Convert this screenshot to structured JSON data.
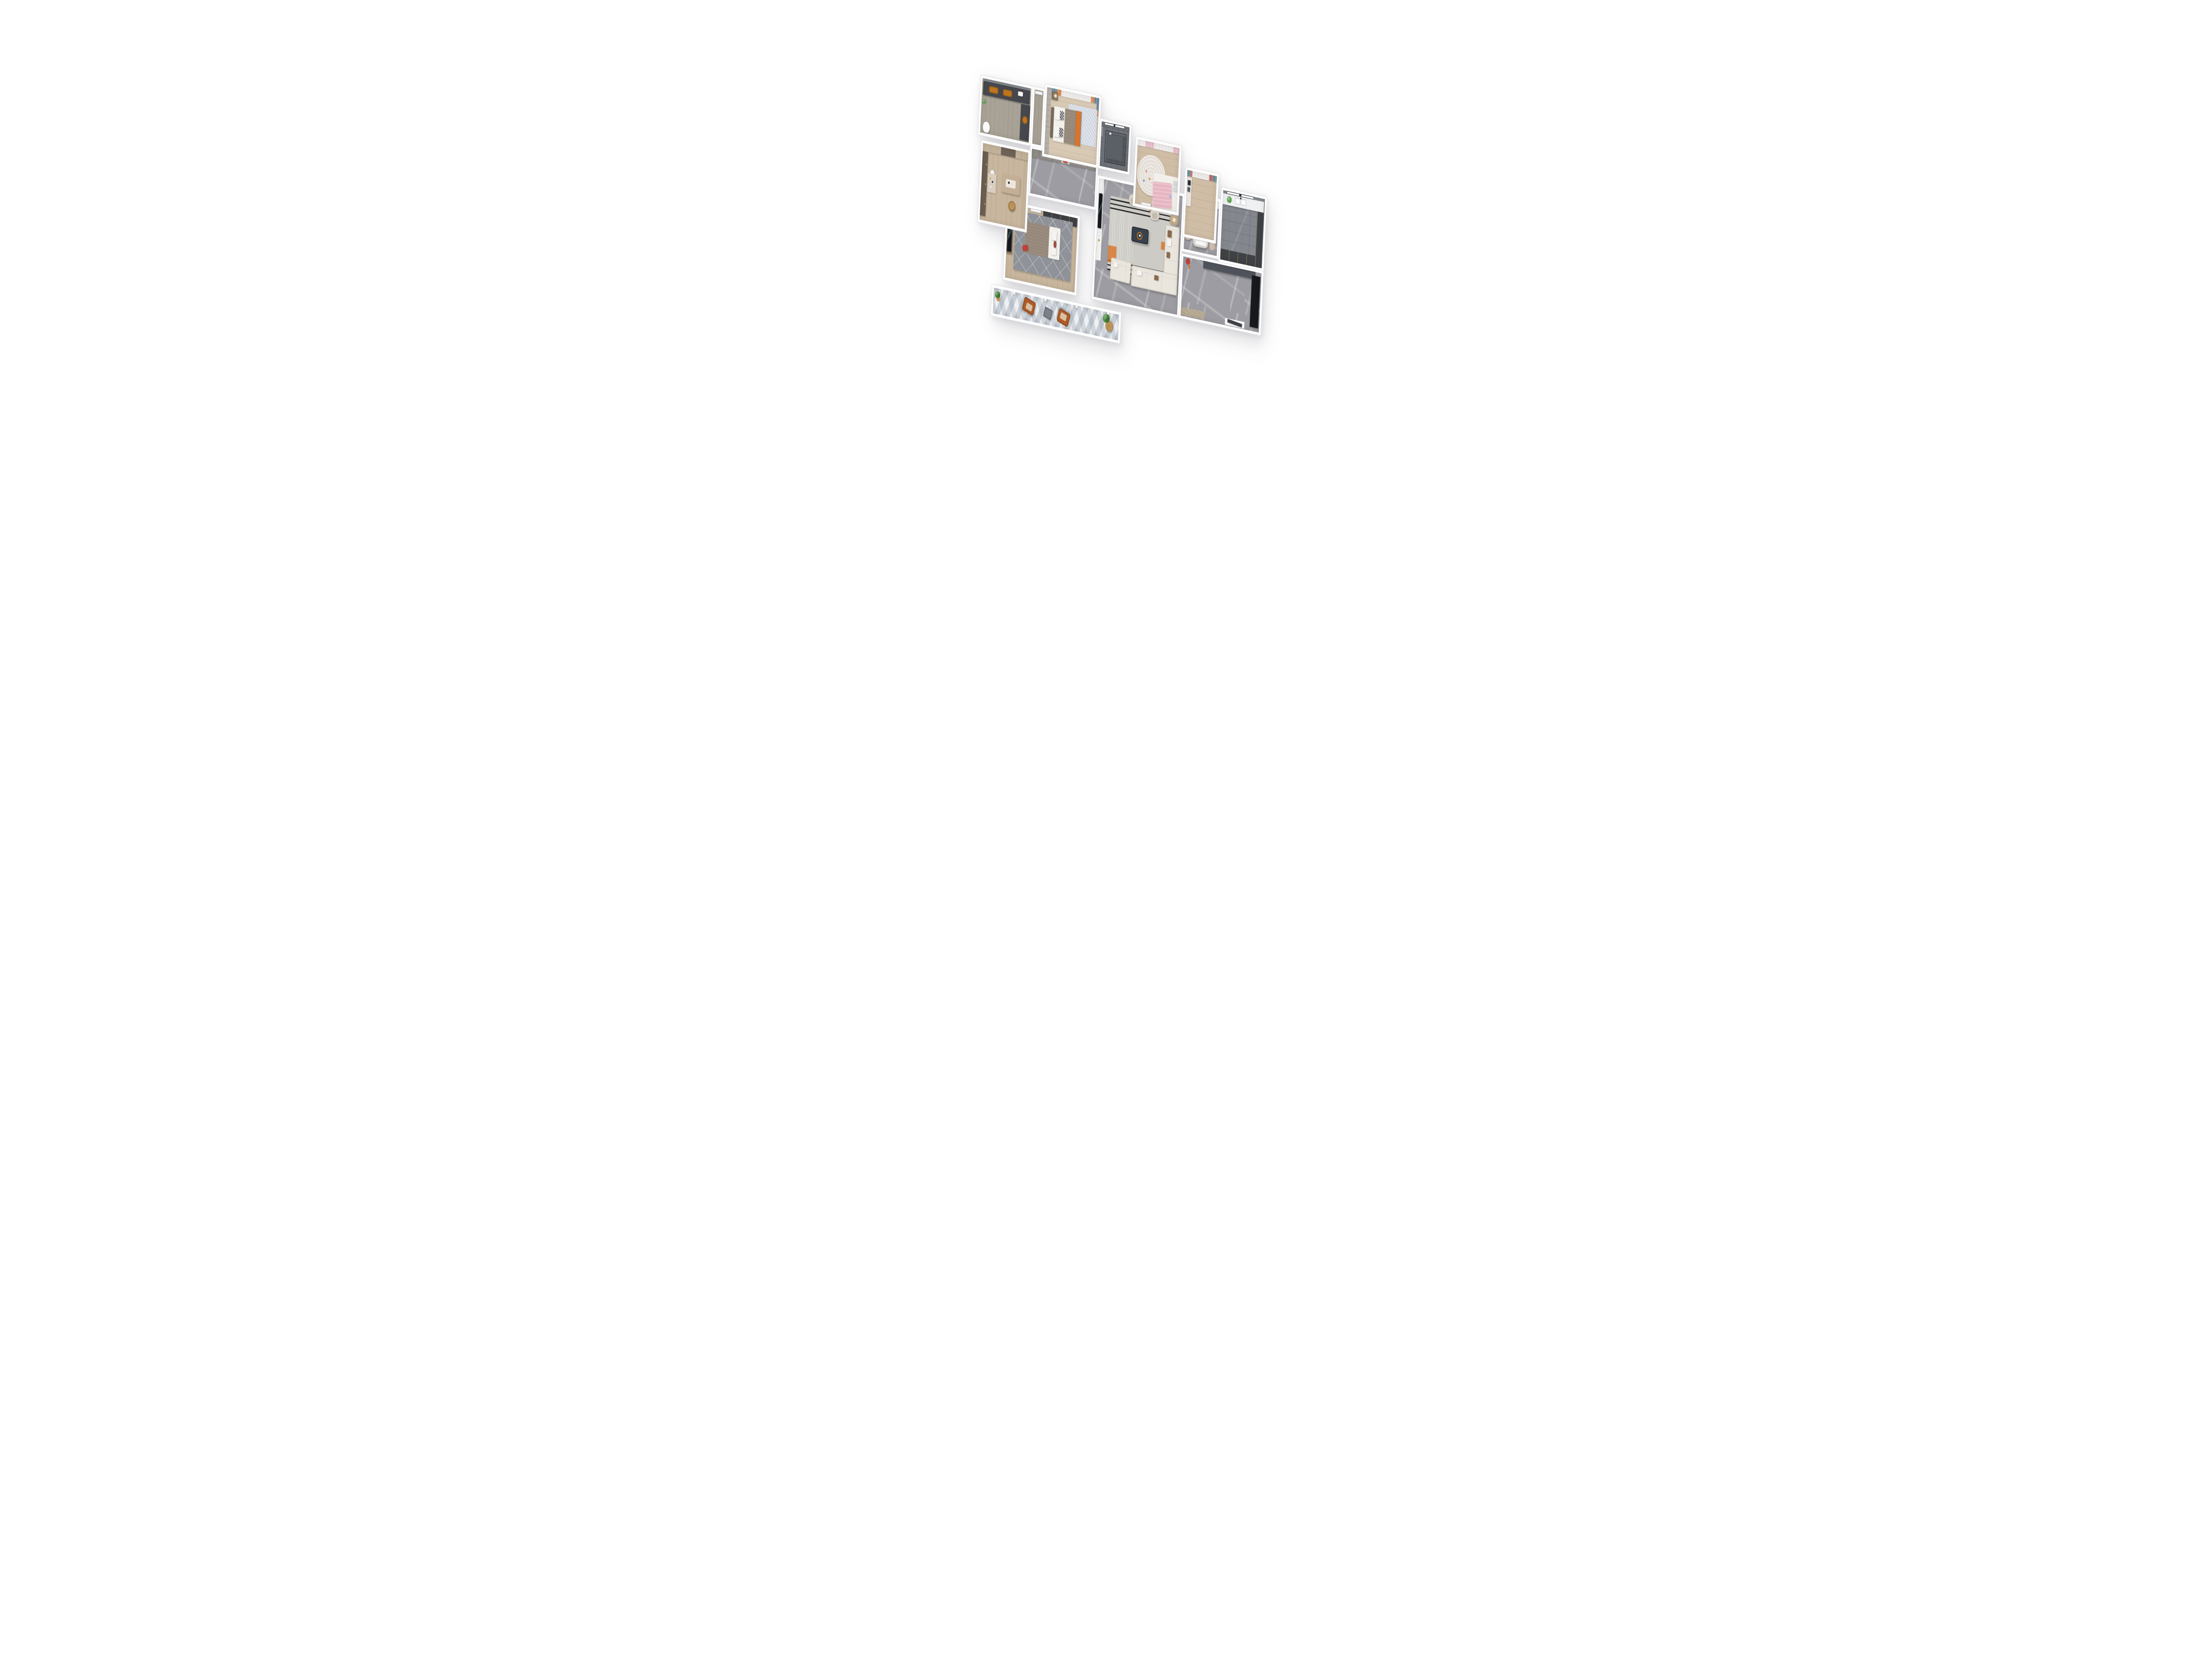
{
  "scene": {
    "type": "3d-floor-plan-render",
    "view": "top-down axonometric",
    "background": "white"
  },
  "palette": {
    "page-bg": "#ffffff",
    "wall": "#ffffff",
    "wall-edge": "#e4e4e8",
    "marble": "#9c9ca2",
    "wood-light": "#d7c9b4",
    "wood-mid": "#cfbda6",
    "wood-warm": "#c8b69e",
    "wood-gray": "#a9a296",
    "kitchen-floor": "#84888e",
    "shower-floor": "#70747a",
    "balcony-tile-a": "#eef0f3",
    "rug-living": "#cccbc5",
    "rug-stripe": "#26262a",
    "rug-bedroom": "#8f9298",
    "rug-kids": "#ece7e0",
    "rug-master": "#e0e4ea",
    "cabinet-dark": "#46484d",
    "cabinet-charcoal": "#3e4145",
    "cabinet-black": "#17191c",
    "cabinet-wood": "#8b7a66",
    "cabinet-tan": "#c2b29a",
    "cabinet-brown": "#6b5f52",
    "wardrobe-gray": "#908b85",
    "panel-gray": "#b8b3aa",
    "counter-white": "#eef0f2",
    "sideboard": "#ebe9e5",
    "bench-gray": "#4f535b",
    "threshold-wood": "#b8ac94",
    "mirror-gray": "#7c8086",
    "door-dark": "#3f4247",
    "tvwall-white": "#f4f3f1",
    "tv-black": "#14171b",
    "tv-glow": "#9fd8de",
    "sofa": "#eae6de",
    "sofa-edge": "#d8d3c8",
    "pillow-brown": "#8a6a4e",
    "taupe": "#998c7e",
    "slate": "#39414d",
    "orange": "#d8752b",
    "orange-deep": "#c0761f",
    "leather": "#ae5b29",
    "leather-dark": "#8d4a20",
    "cushion": "#dcc6a6",
    "blue": "#4c7390",
    "teal": "#3f7e8d",
    "teal-plate": "#3f8796",
    "red": "#a84f49",
    "red-accent": "#c2403a",
    "pink": "#e7b6c3",
    "sheer": "#f2f1ef",
    "chair-beige": "#cdbcab",
    "chair-light": "#d9d3c9",
    "table-gray": "#d6d4cf",
    "sidetable-tan": "#b3a28c",
    "wood-desk": "#c3af96",
    "rattan": "#c79b5e",
    "green": "#4d8a41",
    "green-light": "#57a04a",
    "silver": "#d9dadc",
    "mattress": "#f2f0ea",
    "headboard": "#7a6a5c",
    "gold": "#c9a35c",
    "glass": "rgba(45,52,58,0.45)"
  },
  "rooms": {
    "bathroom": {
      "furniture": [
        "vanity",
        "double-orange-sink",
        "mirror",
        "side-cabinet",
        "round-basin",
        "toilet",
        "plant"
      ]
    },
    "linen-closet": {
      "furniture": [
        "white-door"
      ]
    },
    "master-bedroom": {
      "furniture": [
        "wardrobe-paneling",
        "blue-orange-curtains",
        "double-bed",
        "headboard",
        "zigzag-pillows",
        "orange-runner",
        "nightstand",
        "table-lamp",
        "rug"
      ]
    },
    "ensuite-shower": {
      "furniture": [
        "glass-shower",
        "window",
        "oval-mirror",
        "shower-fixture"
      ]
    },
    "kids-bedroom": {
      "furniture": [
        "pink-white-curtains",
        "round-rug",
        "single-bed",
        "pink-duvet",
        "silver-pillows",
        "teddy-bear",
        "toys"
      ]
    },
    "study": {
      "furniture": [
        "red-teal-curtains",
        "sideboard",
        "picture-frames"
      ]
    },
    "kitchen": {
      "furniture": [
        "window",
        "white-counter",
        "double-sink",
        "plant",
        "tall-cabinets",
        "base-cabinets"
      ]
    },
    "hallway": {
      "furniture": [
        "wardrobe",
        "display-niche",
        "red-artwork"
      ]
    },
    "living-room": {
      "furniture": [
        "tv-feature-wall",
        "tv",
        "striped-rug",
        "coffee-table",
        "orange-tray",
        "sectional-sofa",
        "throw-pillows",
        "accent-chairs",
        "round-side-table",
        "table-lamp"
      ]
    },
    "dining-room": {
      "furniture": [
        "sideboard",
        "picture-frames",
        "dining-table",
        "teal-place-settings",
        "centerpiece-plant",
        "dining-chairs"
      ]
    },
    "entry-hall": {
      "furniture": [
        "shoe-bench",
        "coat-stand",
        "tall-black-cabinet",
        "wood-threshold",
        "entry-door"
      ]
    },
    "bedroom-2": {
      "tv_text": "SKYDANCE",
      "furniture": [
        "dark-wardrobe",
        "tv-cabinet",
        "tv",
        "geometric-rug",
        "double-bed",
        "red-pillow",
        "door"
      ]
    },
    "dressing-room": {
      "furniture": [
        "wall-cabinets",
        "tall-cabinet",
        "vanity",
        "round-mirror",
        "desk",
        "tea-tray",
        "rattan-stool"
      ]
    },
    "balcony": {
      "furniture": [
        "lounge-chair-1",
        "lounge-chair-2",
        "side-table",
        "plant-basket",
        "plant",
        "geometric-tile-floor",
        "sliding-frame-posts"
      ]
    }
  }
}
